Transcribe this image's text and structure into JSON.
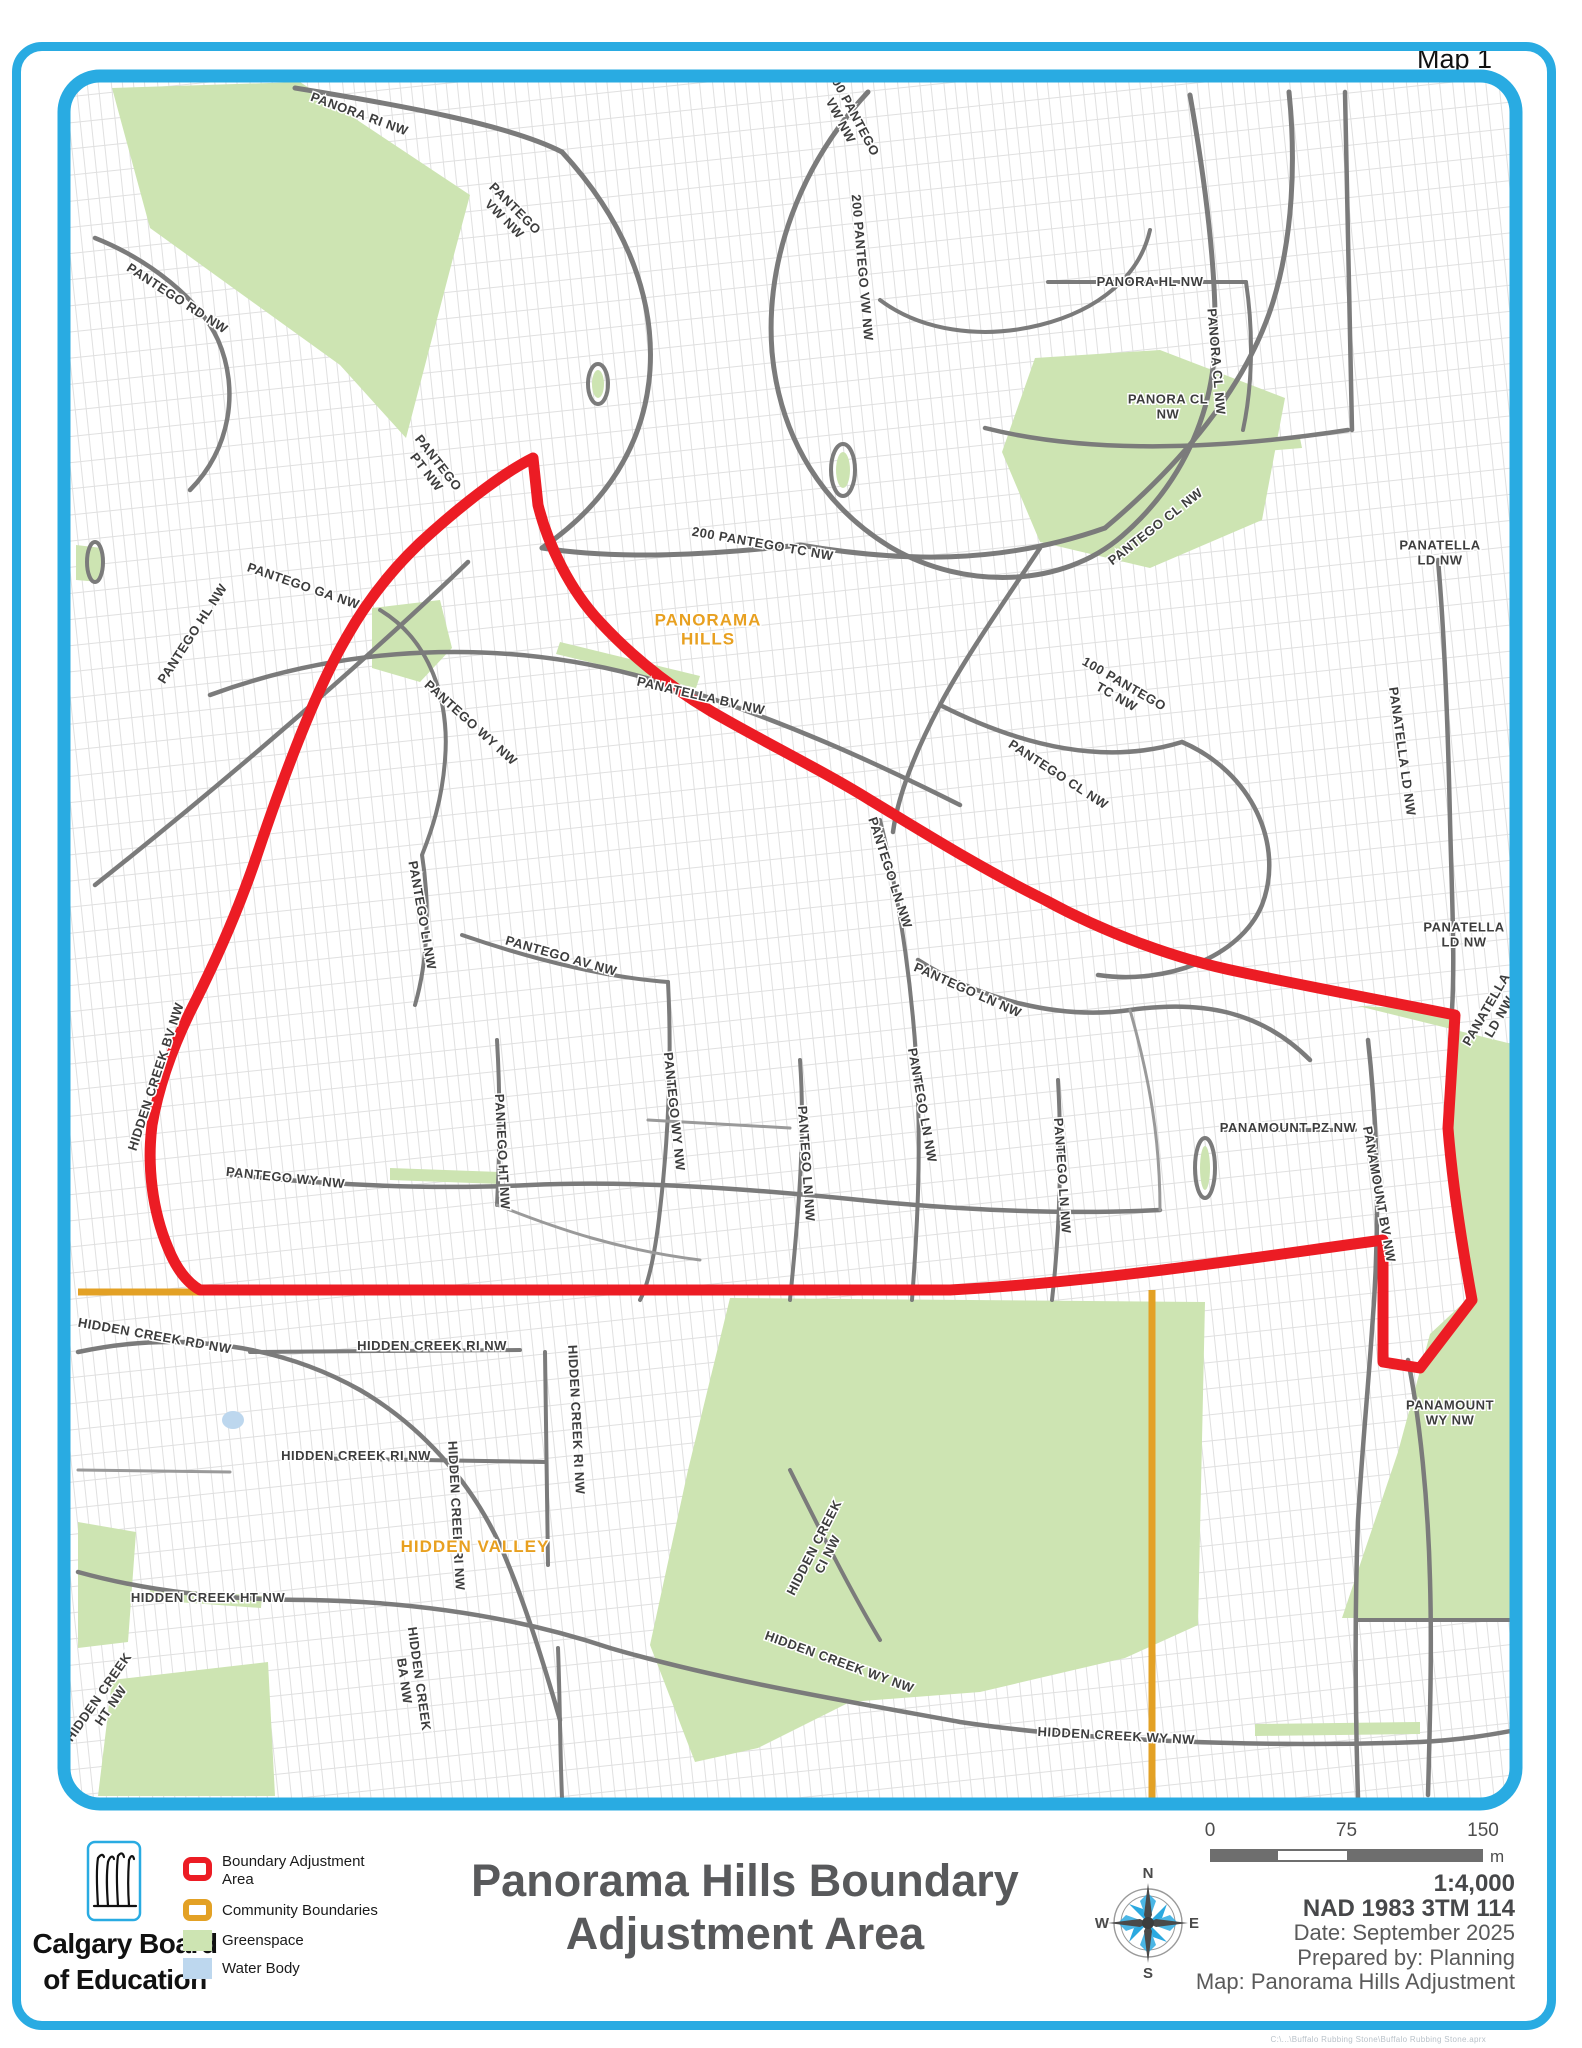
{
  "page": {
    "map_corner_label": "Map 1",
    "footer_path": "C:\\...\\Buffalo Rubbing Stone\\Buffalo Rubbing Stone.aprx"
  },
  "colors": {
    "border_blue": "#29ABE2",
    "boundary_red": "#EC1C24",
    "community_orange": "#E3A125",
    "greenspace": "#CDE4B2",
    "water": "#BDD7EE",
    "road_gray": "#7b7b7b",
    "label_gray": "#3d3d3d",
    "community_label_orange": "#E8A020",
    "title_gray": "#58595B"
  },
  "legend": {
    "items": [
      {
        "key": "boundary-adjustment",
        "label1": "Boundary Adjustment",
        "label2": "Area",
        "style": "line-red"
      },
      {
        "key": "community-boundaries",
        "label1": "Community Boundaries",
        "label2": "",
        "style": "line-orange"
      },
      {
        "key": "greenspace",
        "label1": "Greenspace",
        "label2": "",
        "style": "fill-green"
      },
      {
        "key": "water-body",
        "label1": "Water Body",
        "label2": "",
        "style": "fill-blue"
      }
    ]
  },
  "logo": {
    "line1": "Calgary Board",
    "line2": "of Education"
  },
  "title": {
    "line1": "Panorama Hills Boundary",
    "line2": "Adjustment Area"
  },
  "scalebar": {
    "tick0": "0",
    "tick75": "75",
    "tick150": "150",
    "unit": "m"
  },
  "map_info": {
    "scale": "1:4,000",
    "datum": "NAD 1983 3TM 114",
    "date": "Date: September 2025",
    "prepared": "Prepared by: Planning",
    "map_name": "Map: Panorama Hills Adjustment"
  },
  "compass": {
    "n": "N",
    "e": "E",
    "s": "S",
    "w": "W"
  },
  "map": {
    "community_labels": [
      {
        "t": "PANORAMA",
        "t2": "HILLS",
        "x": 708,
        "y": 634,
        "r": 0
      },
      {
        "t": "HIDDEN VALLEY",
        "x": 475,
        "y": 1552,
        "r": 0
      }
    ],
    "street_labels": [
      {
        "t": "PANORA RI NW",
        "x": 358,
        "y": 118,
        "r": 20
      },
      {
        "t": "PANTEGO",
        "t2": "VW NW",
        "x": 512,
        "y": 218,
        "r": 45
      },
      {
        "t": "PANTEGO RD NW",
        "x": 175,
        "y": 302,
        "r": 33
      },
      {
        "t": "200 PANTEGO",
        "t2": "VW NW",
        "x": 850,
        "y": 122,
        "r": 62
      },
      {
        "t": "200 PANTEGO VW NW",
        "x": 858,
        "y": 268,
        "r": 85
      },
      {
        "t": "PANORA HL NW",
        "x": 1150,
        "y": 286,
        "r": 0
      },
      {
        "t": "PANORA CL NW",
        "x": 1212,
        "y": 362,
        "r": 85
      },
      {
        "t": "PANORA CL",
        "t2": "NW",
        "x": 1168,
        "y": 410,
        "r": 0
      },
      {
        "t": "PANTEGO",
        "t2": "PT NW",
        "x": 435,
        "y": 472,
        "r": 52
      },
      {
        "t": "200 PANTEGO TC NW",
        "x": 762,
        "y": 548,
        "r": 10
      },
      {
        "t": "PANTEGO CL NW",
        "x": 1158,
        "y": 530,
        "r": -38
      },
      {
        "t": "PANATELLA",
        "t2": "LD NW",
        "x": 1440,
        "y": 556,
        "r": 0
      },
      {
        "t": "PANATELLA LD NW",
        "x": 1398,
        "y": 752,
        "r": 82
      },
      {
        "t": "PANATELLA BV NW",
        "x": 700,
        "y": 700,
        "r": 13
      },
      {
        "t": "PANTEGO GA NW",
        "x": 302,
        "y": 590,
        "r": 19
      },
      {
        "t": "PANTEGO HL NW",
        "x": 196,
        "y": 636,
        "r": -57
      },
      {
        "t": "PANTEGO WY NW",
        "x": 468,
        "y": 726,
        "r": 42
      },
      {
        "t": "PANTEGO LI NW",
        "x": 418,
        "y": 916,
        "r": 80
      },
      {
        "t": "PANTEGO AV NW",
        "x": 560,
        "y": 960,
        "r": 16
      },
      {
        "t": "PANTEGO WY NW",
        "x": 670,
        "y": 1112,
        "r": 84
      },
      {
        "t": "PANTEGO HT NW",
        "x": 498,
        "y": 1152,
        "r": 87
      },
      {
        "t": "PANTEGO LN NW",
        "x": 886,
        "y": 874,
        "r": 72
      },
      {
        "t": "PANTEGO LN NW",
        "x": 966,
        "y": 994,
        "r": 24
      },
      {
        "t": "PANTEGO LN NW",
        "x": 918,
        "y": 1106,
        "r": 80
      },
      {
        "t": "PANTEGO LN NW",
        "x": 802,
        "y": 1164,
        "r": 86
      },
      {
        "t": "PANTEGO LN NW",
        "x": 1058,
        "y": 1176,
        "r": 86
      },
      {
        "t": "PANTEGO CL NW",
        "x": 1056,
        "y": 778,
        "r": 33
      },
      {
        "t": "100 PANTEGO",
        "t2": "TC NW",
        "x": 1122,
        "y": 694,
        "r": 30
      },
      {
        "t": "PANAMOUNT PZ NW",
        "x": 1288,
        "y": 1132,
        "r": 0
      },
      {
        "t": "PANAMOUNT BV NW",
        "x": 1375,
        "y": 1195,
        "r": 80
      },
      {
        "t": "PANATELLA",
        "t2": "LD NW",
        "x": 1464,
        "y": 938,
        "r": 0
      },
      {
        "t": "PANATELLA",
        "t2": "LD NW",
        "x": 1490,
        "y": 1018,
        "r": -60
      },
      {
        "t": "HIDDEN CREEK BV NW",
        "x": 160,
        "y": 1078,
        "r": -72
      },
      {
        "t": "PANTEGO WY NW",
        "x": 285,
        "y": 1182,
        "r": 6
      },
      {
        "t": "HIDDEN CREEK RD NW",
        "x": 154,
        "y": 1340,
        "r": 10
      },
      {
        "t": "HIDDEN CREEK RI NW",
        "x": 432,
        "y": 1350,
        "r": 0
      },
      {
        "t": "HIDDEN CREEK RI NW",
        "x": 356,
        "y": 1460,
        "r": 0
      },
      {
        "t": "HIDDEN CREEK RI NW",
        "x": 452,
        "y": 1516,
        "r": 87
      },
      {
        "t": "HIDDEN CREEK RI NW",
        "x": 572,
        "y": 1420,
        "r": 87
      },
      {
        "t": "HIDDEN CREEK HT NW",
        "x": 208,
        "y": 1602,
        "r": 0
      },
      {
        "t": "HIDDEN CREEK",
        "t2": "HT NW",
        "x": 102,
        "y": 1706,
        "r": -55
      },
      {
        "t": "HIDDEN CREEK",
        "t2": "BA NW",
        "x": 415,
        "y": 1686,
        "r": 82
      },
      {
        "t": "HIDDEN CREEK",
        "t2": "CI NW",
        "x": 818,
        "y": 1556,
        "r": -63
      },
      {
        "t": "HIDDEN CREEK WY NW",
        "x": 838,
        "y": 1666,
        "r": 20
      },
      {
        "t": "HIDDEN CREEK WY NW",
        "x": 1116,
        "y": 1740,
        "r": 3
      },
      {
        "t": "PANAMOUNT",
        "t2": "WY NW",
        "x": 1450,
        "y": 1416,
        "r": 0
      }
    ],
    "greenspaces": [
      "112,88 300,82 470,195 452,262 406,438 340,365 150,228",
      "1035,358 1160,350 1285,398 1262,520 1150,568 1040,542 1002,452",
      "372,608 440,600 452,648 420,682 372,668",
      "76,545 102,548 100,582 76,580",
      "1358,1006 1452,1010 1446,1115 1475,1292 1430,1334 1398,1452 1342,1618 1516,1618 1516,1045",
      "730,1298 1205,1302 1198,1625 1125,1658 980,1692 850,1702 758,1748 695,1762 650,1645 688,1470",
      "78,1522 136,1532 128,1642 78,1648",
      "112,1680 268,1662 275,1796 98,1796",
      "560,642 700,676 696,688 556,654",
      "390,1168 500,1172 500,1184 390,1180",
      "150,1588 262,1596 261,1608 149,1600",
      "1255,1724 1420,1722 1420,1734 1255,1736",
      "1240,443 1300,438 1302,448 1242,453"
    ],
    "green_ovals": [
      {
        "cx": 598,
        "cy": 384,
        "rx": 6,
        "ry": 14
      },
      {
        "cx": 95,
        "cy": 562,
        "rx": 4,
        "ry": 14
      },
      {
        "cx": 843,
        "cy": 470,
        "rx": 7,
        "ry": 18
      },
      {
        "cx": 1205,
        "cy": 1168,
        "rx": 5,
        "ry": 22
      }
    ],
    "water_bodies": [
      {
        "cx": 233,
        "cy": 1420,
        "rx": 11,
        "ry": 9
      }
    ],
    "roads": [
      {
        "d": "M295,88 C400,105 510,125 562,152",
        "w": 5
      },
      {
        "d": "M562,152 C620,215 655,290 650,370 C645,445 605,505 542,548",
        "w": 5
      },
      {
        "d": "M868,92 C800,165 765,260 772,352 C780,440 825,508 892,548 C965,590 1062,588 1122,536 C1182,484 1212,415 1215,345 C1217,270 1205,180 1190,95",
        "w": 5
      },
      {
        "d": "M880,300 C920,330 980,340 1040,325 C1100,310 1140,275 1150,230",
        "w": 4
      },
      {
        "d": "M542,548 C620,560 710,555 800,545 C900,562 1000,565 1105,528",
        "w": 5
      },
      {
        "d": "M1105,528 C1180,465 1246,388 1273,302 C1293,237 1296,160 1289,92",
        "w": 5
      },
      {
        "d": "M1048,282 L1246,282",
        "w": 4
      },
      {
        "d": "M1246,282 C1254,335 1252,388 1243,430",
        "w": 4
      },
      {
        "d": "M985,428 C1072,450 1192,454 1348,430",
        "w": 4.5
      },
      {
        "d": "M1345,92 L1352,430",
        "w": 4.5
      },
      {
        "d": "M1040,548 C1002,605 965,658 940,705 C915,752 898,795 893,832",
        "w": 4.5
      },
      {
        "d": "M940,705 C1025,748 1108,765 1182,742",
        "w": 4.5
      },
      {
        "d": "M1182,742 C1252,772 1285,845 1262,905 C1240,958 1165,985 1098,975",
        "w": 4.5
      },
      {
        "d": "M95,885 C225,782 372,655 468,562",
        "w": 4.5
      },
      {
        "d": "M210,695 C360,640 520,640 660,682 C780,718 880,765 960,805",
        "w": 4.5
      },
      {
        "d": "M95,238 C150,260 200,300 218,340 C240,390 230,450 190,490",
        "w": 4.5
      },
      {
        "d": "M380,610 C430,640 450,700 445,760 C442,800 432,830 422,855 C430,905 428,960 415,1005",
        "w": 4
      },
      {
        "d": "M462,935 C540,962 612,978 668,982",
        "w": 4
      },
      {
        "d": "M668,982 C672,1060 668,1140 660,1210 C655,1255 648,1285 640,1300",
        "w": 4
      },
      {
        "d": "M497,1040 C500,1090 500,1150 497,1205",
        "w": 4
      },
      {
        "d": "M800,1060 C805,1130 800,1200 790,1300",
        "w": 4
      },
      {
        "d": "M880,820 C900,900 915,1000 918,1100 C920,1160 918,1220 912,1300",
        "w": 4
      },
      {
        "d": "M1058,1080 C1062,1150 1060,1230 1052,1300",
        "w": 4
      },
      {
        "d": "M918,960 C980,1000 1060,1020 1130,1010 C1200,1000 1260,1010 1310,1060",
        "w": 4.5
      },
      {
        "d": "M1222,1130 L1355,1130",
        "w": 4
      },
      {
        "d": "M1368,1040 C1378,1130 1380,1230 1372,1330 C1368,1390 1362,1450 1358,1520 C1355,1600 1355,1700 1358,1798",
        "w": 4.5
      },
      {
        "d": "M1438,560 C1445,640 1448,730 1450,820 C1452,900 1455,960 1452,1010",
        "w": 4.5
      },
      {
        "d": "M230,1175 C330,1185 430,1190 530,1185 C640,1180 760,1190 860,1200 C960,1210 1060,1215 1160,1210",
        "w": 4.5
      },
      {
        "d": "M78,1352 C180,1330 280,1345 360,1390 C420,1425 470,1480 500,1545 C520,1590 540,1650 560,1720",
        "w": 4.5
      },
      {
        "d": "M290,1458 L545,1462",
        "w": 4
      },
      {
        "d": "M545,1352 L548,1565",
        "w": 4
      },
      {
        "d": "M250,1352 L520,1350",
        "w": 4
      },
      {
        "d": "M78,1572 C150,1592 230,1600 310,1600 C420,1602 520,1618 610,1648",
        "w": 4.5
      },
      {
        "d": "M610,1648 C720,1680 840,1700 960,1722 C1080,1740 1250,1748 1420,1742 C1460,1740 1490,1735 1516,1730",
        "w": 4.5
      },
      {
        "d": "M790,1470 C820,1530 850,1590 880,1640",
        "w": 4
      },
      {
        "d": "M558,1648 C560,1700 560,1750 562,1798",
        "w": 4
      },
      {
        "d": "M1408,1360 C1420,1420 1428,1500 1430,1580 C1432,1650 1430,1720 1428,1795",
        "w": 4.5
      },
      {
        "d": "M1358,1620 L1516,1620",
        "w": 4
      },
      {
        "d": "M648,1120 L790,1128",
        "w": 3
      },
      {
        "d": "M497,1205 C560,1230 620,1250 700,1260",
        "w": 3
      },
      {
        "d": "M78,1470 L230,1472",
        "w": 3
      },
      {
        "d": "M1130,1010 C1150,1080 1160,1140 1160,1210",
        "w": 3
      }
    ],
    "road_ovals": [
      {
        "cx": 598,
        "cy": 384,
        "rx": 10,
        "ry": 20
      },
      {
        "cx": 95,
        "cy": 562,
        "rx": 8,
        "ry": 20
      },
      {
        "cx": 843,
        "cy": 470,
        "rx": 12,
        "ry": 26
      },
      {
        "cx": 1205,
        "cy": 1168,
        "rx": 10,
        "ry": 30
      }
    ],
    "boundary_adjustment_path": "M533,458 C505,472 468,500 432,532 C400,560 370,595 345,640 C315,692 285,772 258,852 C238,912 215,962 196,1000 C178,1035 160,1078 152,1125 C147,1165 152,1210 168,1248 C176,1268 186,1282 200,1290 L950,1290 C1100,1282 1250,1258 1383,1240 L1383,1362 L1420,1368 L1472,1300 C1462,1245 1452,1180 1448,1128 L1455,1015 C1380,1000 1300,985 1240,972 C1170,958 1100,930 1045,900 C980,868 920,830 870,800 C830,775 780,750 730,722 C680,695 635,660 600,622 C570,590 548,545 538,505 Z",
    "community_boundary_paths": [
      "M78,1292 L200,1292",
      "M1152,1290 L1152,1798"
    ]
  }
}
